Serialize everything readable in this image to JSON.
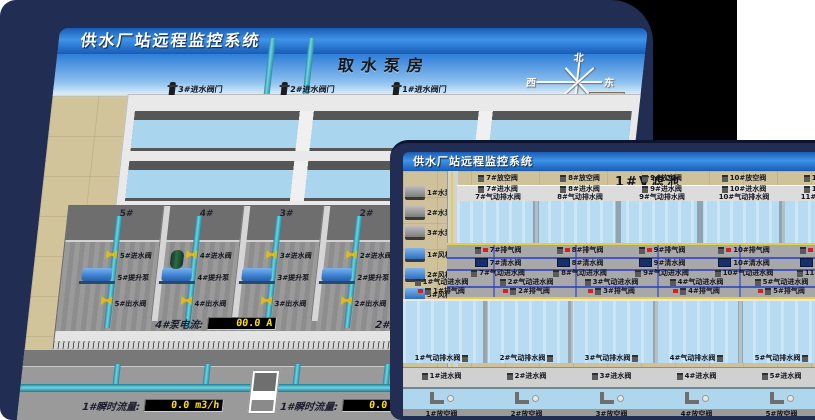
{
  "colors": {
    "bezel_navy": "#212d53",
    "titlebar_blue": "#3f93e8",
    "sky_blue": "#2e7ed8",
    "floor_tan": "#d2c49a",
    "water_blue": "#b7dcf2",
    "pipe_cyan": "#6fd4e4",
    "valve_yellow": "#ddb91c",
    "led_text_yellow": "#ffe400",
    "alarm_red": "#d42020",
    "pipe_dark_blue": "#2233c0"
  },
  "back_window": {
    "titlebar": "供水厂站远程监控系统",
    "scene_title": "取水泵房",
    "pump_selector": "5#泵",
    "readouts": [
      {
        "label": "轴承温度1:",
        "value": "100.0",
        "unit": "℃"
      },
      {
        "label": "轴承温度2:",
        "value": "100.0",
        "unit": "℃"
      },
      {
        "label": "电机温度1:",
        "value": "18.1",
        "unit": "℃"
      },
      {
        "label": "电机温度2:",
        "value": "17.9",
        "unit": "℃"
      },
      {
        "label": "绕组温度1:",
        "value": "18.0",
        "unit": "℃"
      },
      {
        "label": "绕组温度2:",
        "value": "18.1",
        "unit": "℃"
      },
      {
        "label": "绕组温度3:",
        "value": "18.1",
        "unit": "℃"
      },
      {
        "label": "管道压力:",
        "value": "0.0007",
        "unit": "MPa"
      },
      {
        "label": "多功能阀:",
        "value": "0",
        "unit": "%"
      }
    ],
    "inlet_gate_valves": [
      "3#进水阀门",
      "2#进水阀门",
      "1#进水阀门"
    ],
    "bays": [
      {
        "no": "5#",
        "inlet": "5#进水阀",
        "pump": "5#提升泵",
        "outlet": "5#出水阀"
      },
      {
        "no": "4#",
        "inlet": "4#进水阀",
        "pump": "4#提升泵",
        "outlet": "4#出水阀"
      },
      {
        "no": "3#",
        "inlet": "3#进水阀",
        "pump": "3#提升泵",
        "outlet": "3#出水阀"
      },
      {
        "no": "2#",
        "inlet": "2#进水阀",
        "pump": "2#提升泵",
        "outlet": "2#出水阀"
      }
    ],
    "current_readouts": [
      {
        "label": "4#泵电流:",
        "value": "00.0 A"
      },
      {
        "label": "2#泵电流:",
        "value": "00.0 A"
      }
    ],
    "flow_readouts": [
      {
        "label": "1#瞬时流量:",
        "value": "0.0 m3/h"
      },
      {
        "label": "1#瞬时流量:",
        "value": "0.0 m3/h"
      }
    ],
    "compass": {
      "n": "北",
      "w": "西",
      "s": "南",
      "e": "东"
    },
    "side_panel": {
      "pump": "1#泵",
      "labels": [
        "轴承温度1:",
        "轴承温度2:"
      ]
    }
  },
  "front_window": {
    "titlebar": "供水厂站远程监控系统",
    "scene_title": "1#V滤池",
    "water_pumps": [
      "1#水泵",
      "2#水泵",
      "3#水泵"
    ],
    "blowers": [
      "1#风机",
      "2#风机",
      "3#风机"
    ],
    "rows": {
      "top_drain": [
        "7#放空阀",
        "8#放空阀",
        "9#放空阀",
        "10#放空阀",
        "11#放空阀",
        "12#放空阀"
      ],
      "top_inlet": [
        "7#进水阀",
        "8#进水阀",
        "9#进水阀",
        "10#进水阀",
        "11#进水阀",
        "12#进水阀"
      ],
      "top_pneu_drain": [
        "7#气动排水阀",
        "8#气动排水阀",
        "9#气动排水阀",
        "10#气动排水阀",
        "11#气动排水阀",
        "12#气动排水阀"
      ],
      "deck_vent_high": [
        "7#排气阀",
        "8#排气阀",
        "9#排气阀",
        "10#排气阀",
        "11#排气阀",
        "12#排气阀"
      ],
      "deck_clear_high": [
        "7#清水阀",
        "8#清水阀",
        "9#清水阀",
        "10#清水阀",
        "11#清水阀",
        "12#清水阀"
      ],
      "deck_pneu_inlet_high": [
        "7#气动进水阀",
        "8#气动进水阀",
        "9#气动进水阀",
        "10#气动进水阀",
        "11#气动进水阀",
        "12#气动进水阀"
      ],
      "deck_pneu_inlet_low": [
        "1#气动进水阀",
        "2#气动进水阀",
        "3#气动进水阀",
        "4#气动进水阀",
        "5#气动进水阀",
        "6#气动进水阀"
      ],
      "deck_vent_low": [
        "1#排气阀",
        "2#排气阀",
        "3#排气阀",
        "4#排气阀",
        "5#排气阀",
        "6#排气阀"
      ],
      "lower_pneu_drain": [
        "1#气动排水阀",
        "2#气动排水阀",
        "3#气动排水阀",
        "4#气动排水阀",
        "5#气动排水阀",
        "6#气动排水阀"
      ],
      "lower_inlet": [
        "1#进水阀",
        "2#进水阀",
        "3#进水阀",
        "4#进水阀",
        "5#进水阀",
        "6#进水阀"
      ],
      "lower_drain": [
        "1#放空阀",
        "2#放空阀",
        "3#放空阀",
        "4#放空阀",
        "5#放空阀",
        "6#放空阀"
      ]
    }
  }
}
